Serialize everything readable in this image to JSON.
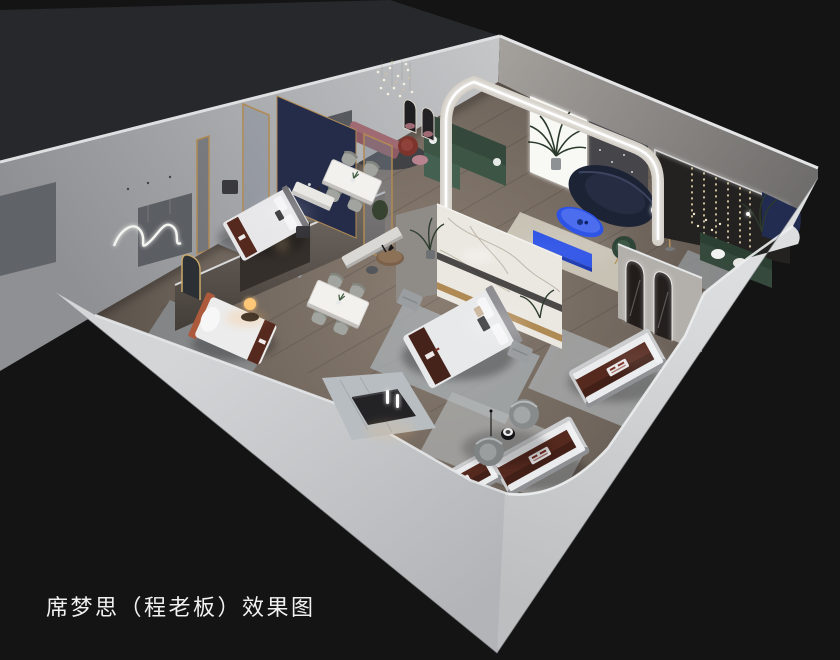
{
  "caption": {
    "text": "席梦思（程老板）效果图"
  },
  "palette": {
    "background": "#141414",
    "outer_wall_light": "#d3d5d7",
    "outer_wall_shade": "#b2b4b7",
    "inner_wall": "#9a9b9e",
    "floor_wood": "#6f655c",
    "accent_blue": "#2d53e6",
    "mattress_brown": "#55291e",
    "sofa_green": "#3c5545",
    "sofa_navy": "#1c2335",
    "led_white": "#ffffff",
    "warm_lamp": "#ffc878",
    "gold_trim": "#b08a54",
    "marble_white": "#ebe8e2",
    "caption_text": "#f1f1f1"
  },
  "scene": {
    "type": "isometric-cutaway-interior-render",
    "objects": [
      "bed-display",
      "mattress-display",
      "dining-set",
      "lounge-sofa-set",
      "arched-led-wall",
      "marble-partition",
      "neon-squiggle-light",
      "crystal-chandelier",
      "string-lights",
      "armchair-set",
      "entry-alcove"
    ]
  }
}
